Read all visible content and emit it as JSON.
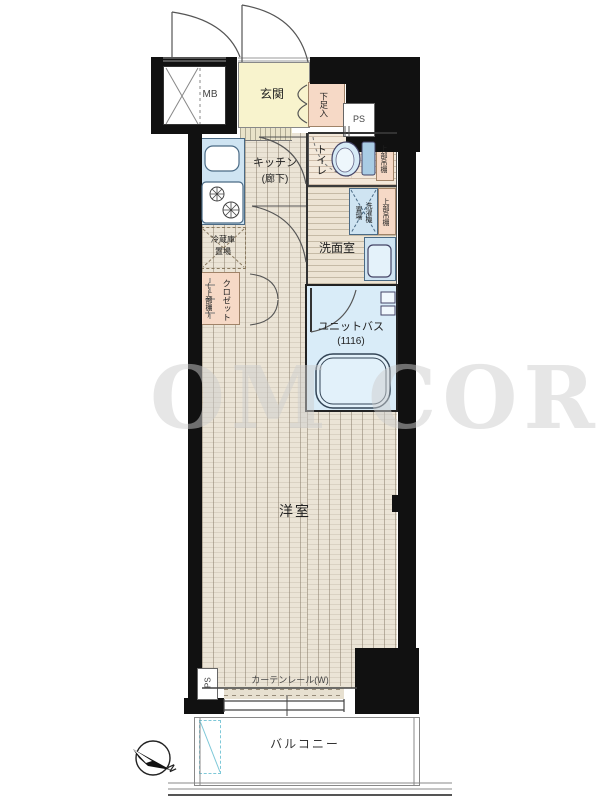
{
  "title": "apartment-floor-plan",
  "labels": {
    "mb": "MB",
    "genkan": "玄関",
    "shoe_cabinet": "下足入",
    "ps_top": "PS",
    "toilet": "トイレ",
    "shelf_toilet": "上部吊棚",
    "shelf_laundry": "上部吊棚",
    "laundry_1": "洗濯機",
    "laundry_2": "置場",
    "kitchen_1": "キッチン",
    "kitchen_2": "(廊下)",
    "fridge_1": "冷蔵庫",
    "fridge_2": "置場",
    "closet": "クロゼット",
    "closet_shelf": "(上部棚)",
    "washroom": "洗面室",
    "unit_bath": "ユニットバス",
    "unit_bath_size": "(1116)",
    "main_room": "洋室",
    "curtain_rail": "カーテンレール(W)",
    "ps_bottom": "PS",
    "balcony": "バルコニー",
    "north": "N",
    "watermark": "OM COR"
  },
  "colors": {
    "wall": "#111111",
    "genkan_floor": "#f8f3cd",
    "storage_pink": "#f6d9c6",
    "fixture_blue": "#cfe4f2",
    "bath_blue": "#d9ecf8",
    "wood_floor": "#ebe4d6",
    "toilet_floor": "#f3e8da",
    "washroom_floor": "#ece3d3",
    "hatch_cyan": "#7ec8d8"
  }
}
